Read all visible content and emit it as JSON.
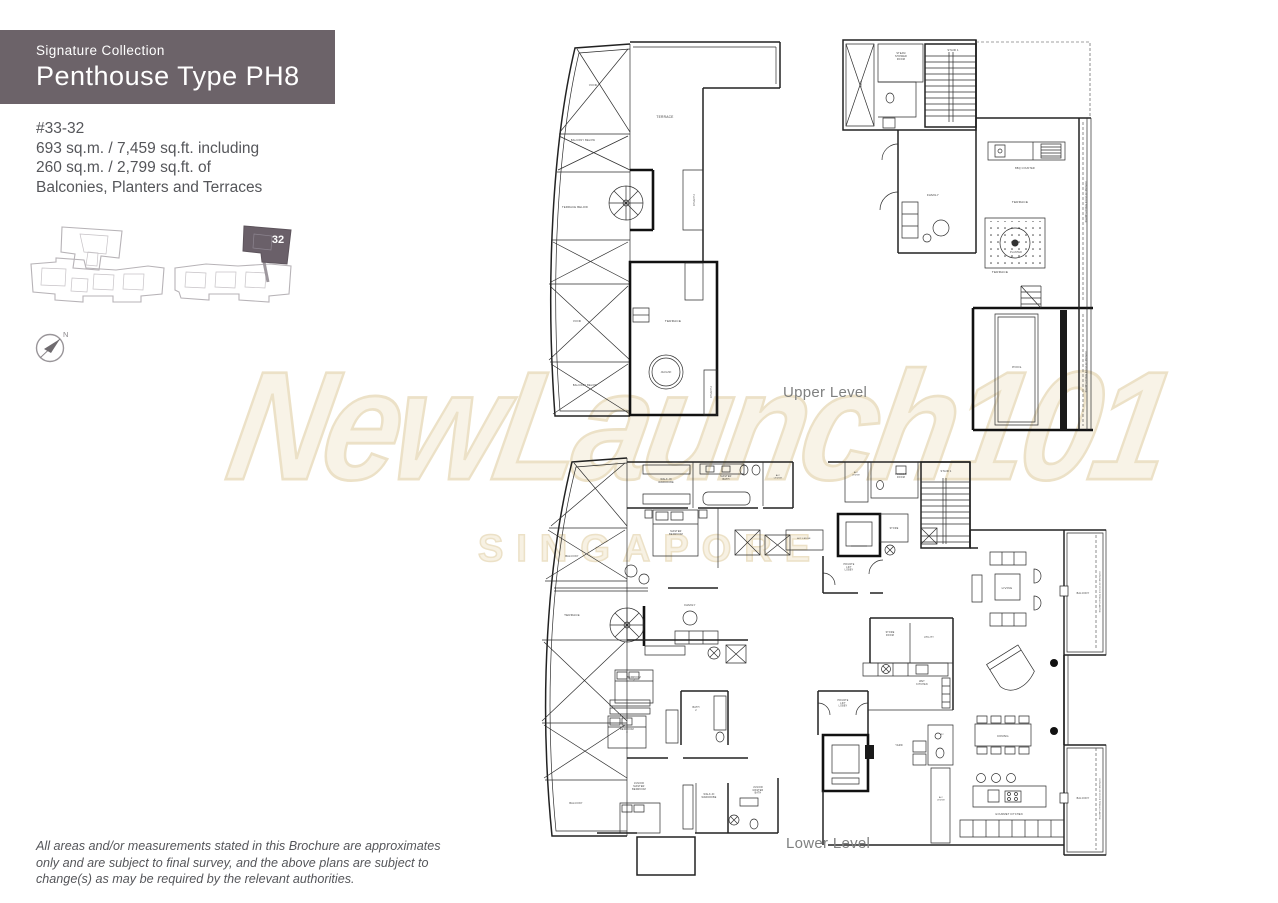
{
  "header": {
    "collection": "Signature Collection",
    "title": "Penthouse Type PH8",
    "bg": "#6c6369"
  },
  "unit_info": {
    "unit": "#33-32",
    "line1": "693 sq.m. / 7,459 sq.ft. including",
    "line2": "260 sq.m. / 2,799 sq.ft. of",
    "line3": "Balconies, Planters and Terraces"
  },
  "key_plan": {
    "highlight_label": "32",
    "highlight_color": "#6a6069",
    "outline_color": "#b7b3b7"
  },
  "compass": {
    "label": "N"
  },
  "watermark": {
    "line1": "NewLaunch101",
    "line2": "SINGAPORE",
    "fill": "#f8f3e7",
    "stroke": "#ece1c7"
  },
  "plans": {
    "upper": {
      "caption": "Upper Level",
      "labels": [
        {
          "t": "VOID",
          "x": 60,
          "y": 64,
          "s": 3
        },
        {
          "t": "BALCONY BELOW",
          "x": 50,
          "y": 119,
          "s": 2.5
        },
        {
          "t": "TERRACE BELOW",
          "x": 42,
          "y": 186,
          "s": 2.7
        },
        {
          "t": "VOID",
          "x": 44,
          "y": 300,
          "s": 3
        },
        {
          "t": "BALCONY BELOW",
          "x": 52,
          "y": 364,
          "s": 2.5
        },
        {
          "t": "TERRACE",
          "x": 132,
          "y": 96,
          "s": 3.3
        },
        {
          "t": "PLANTER",
          "x": 160,
          "y": 178,
          "s": 2.3,
          "rot": 90
        },
        {
          "t": "TERRACE",
          "x": 140,
          "y": 300,
          "s": 3.1
        },
        {
          "t": "JACUZZI",
          "x": 133,
          "y": 351,
          "s": 2.3
        },
        {
          "t": "PLANTER",
          "x": 177,
          "y": 370,
          "s": 2.3,
          "rot": 90
        },
        {
          "t": "VOID",
          "x": 327,
          "y": 62,
          "s": 2.5,
          "rot": 90
        },
        {
          "t": "STEAM\nSHOWER\nROOM",
          "x": 368,
          "y": 32,
          "s": 2.4
        },
        {
          "t": "STAIR 1",
          "x": 420,
          "y": 29,
          "s": 2.7
        },
        {
          "t": "FAMILY",
          "x": 400,
          "y": 174,
          "s": 3.1
        },
        {
          "t": "BBQ COUNTER",
          "x": 492,
          "y": 147,
          "s": 2.4
        },
        {
          "t": "TERRACE",
          "x": 487,
          "y": 181,
          "s": 3.1
        },
        {
          "t": "PLANTER",
          "x": 483,
          "y": 231,
          "s": 2.3
        },
        {
          "t": "TERRACE",
          "x": 467,
          "y": 251,
          "s": 3.1
        },
        {
          "t": "POOL",
          "x": 484,
          "y": 346,
          "s": 3.1
        },
        {
          "t": "OUTLINE OF ROOF TRELLIS ABOVE",
          "x": 552,
          "y": 180,
          "s": 2.1,
          "rot": 90
        },
        {
          "t": "OUTLINE OF ROOF TRELLIS ABOVE",
          "x": 552,
          "y": 350,
          "s": 2.1,
          "rot": 90
        }
      ]
    },
    "lower": {
      "caption": "Lower Level",
      "labels": [
        {
          "t": "BALCONY",
          "x": 54,
          "y": 109,
          "s": 2.5
        },
        {
          "t": "TERRACE",
          "x": 54,
          "y": 168,
          "s": 3
        },
        {
          "t": "BALCONY",
          "x": 58,
          "y": 356,
          "s": 2.5
        },
        {
          "t": "WALK-IN\nWARDROBE",
          "x": 148,
          "y": 32,
          "s": 2.4
        },
        {
          "t": "MASTER\nBATH",
          "x": 208,
          "y": 29,
          "s": 2.4
        },
        {
          "t": "A/C\nLEDGE",
          "x": 260,
          "y": 28,
          "s": 2.2
        },
        {
          "t": "MASTER\nBEDROOM",
          "x": 158,
          "y": 84,
          "s": 2.4
        },
        {
          "t": "FAMILY",
          "x": 172,
          "y": 158,
          "s": 2.9
        },
        {
          "t": "BEDROOM\n2",
          "x": 116,
          "y": 230,
          "s": 2.4
        },
        {
          "t": "BEDROOM\n3",
          "x": 109,
          "y": 282,
          "s": 2.4
        },
        {
          "t": "BATH\n2",
          "x": 178,
          "y": 260,
          "s": 2.4
        },
        {
          "t": "JUNIOR\nMASTER\nBEDROOM",
          "x": 121,
          "y": 336,
          "s": 2.4
        },
        {
          "t": "WALK-IN\nWARDROBE",
          "x": 191,
          "y": 347,
          "s": 2.3
        },
        {
          "t": "JUNIOR\nMASTER\nBATH",
          "x": 240,
          "y": 340,
          "s": 2.3
        },
        {
          "t": "A/C LEDGE",
          "x": 286,
          "y": 91,
          "s": 2.2
        },
        {
          "t": "A/C\nLEDGE",
          "x": 338,
          "y": 25,
          "s": 2.1
        },
        {
          "t": "POWDER\nROOM",
          "x": 383,
          "y": 27,
          "s": 2.3
        },
        {
          "t": "STAIR 1",
          "x": 428,
          "y": 24,
          "s": 2.6
        },
        {
          "t": "STORE",
          "x": 376,
          "y": 81,
          "s": 2.3
        },
        {
          "t": "PRIVATE\nLIFT\nLOBBY",
          "x": 331,
          "y": 117,
          "s": 2.3
        },
        {
          "t": "PRIVATE\nLIFT\nLOBBY",
          "x": 325,
          "y": 253,
          "s": 2.3
        },
        {
          "t": "STORE\nROOM",
          "x": 372,
          "y": 185,
          "s": 2.3
        },
        {
          "t": "UTILITY",
          "x": 411,
          "y": 190,
          "s": 2.3
        },
        {
          "t": "WET\nKITCHEN",
          "x": 404,
          "y": 234,
          "s": 2.3
        },
        {
          "t": "YARD",
          "x": 381,
          "y": 298,
          "s": 2.5
        },
        {
          "t": "WC",
          "x": 424,
          "y": 287,
          "s": 2.1
        },
        {
          "t": "A/C\nLEDGE",
          "x": 423,
          "y": 350,
          "s": 2.1
        },
        {
          "t": "LIVING",
          "x": 489,
          "y": 141,
          "s": 2.9
        },
        {
          "t": "DINING",
          "x": 485,
          "y": 289,
          "s": 2.9
        },
        {
          "t": "GOURMET KITCHEN",
          "x": 491,
          "y": 367,
          "s": 2.5
        },
        {
          "t": "BALCONY",
          "x": 565,
          "y": 146,
          "s": 2.4
        },
        {
          "t": "BALCONY",
          "x": 565,
          "y": 351,
          "s": 2.4
        },
        {
          "t": "OUTLINE OF ROOF TRELLIS ABOVE",
          "x": 581,
          "y": 144,
          "s": 2.1,
          "rot": 90
        },
        {
          "t": "OUTLINE OF ROOF TRELLIS ABOVE",
          "x": 581,
          "y": 351,
          "s": 2.1,
          "rot": 90
        }
      ]
    }
  },
  "disclaimer": {
    "line1": "All areas and/or measurements stated in this Brochure are approximates",
    "line2": "only and are subject to final survey, and the above plans are subject to",
    "line3": "change(s) as may be required by the relevant authorities."
  }
}
